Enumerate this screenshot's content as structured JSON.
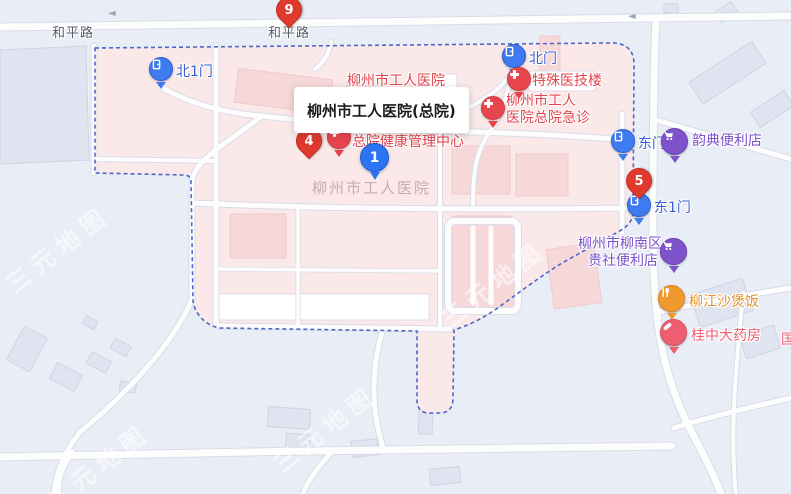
{
  "map": {
    "road_label_left": "和平路",
    "road_label_center": "和平路",
    "road_arrow": "◄",
    "watermark": "三元地图",
    "area_label": "柳州市工人医院",
    "edge_partial_label": "国"
  },
  "popup": {
    "title": "柳州市工人医院(总院)"
  },
  "pins": {
    "pin9": "9",
    "pin4": "4",
    "pin5": "5",
    "pin1": "1"
  },
  "gates": {
    "north1": "北1门",
    "north": "北门",
    "east": "东门",
    "east1": "东1门"
  },
  "pois": {
    "special_building": "特殊医技楼",
    "emergency_line1": "柳州市工人",
    "emergency_line2": "医院总院急诊",
    "hidden_top": "柳州市工人医院",
    "health_line1": "柳州市工人医院",
    "health_line2": "总院健康管理中心",
    "yundian": "韵典便利店",
    "guishe_line1": "柳州市柳南区",
    "guishe_line2": "贵社便利店",
    "liujiang": "柳江沙煲饭",
    "pharmacy": "桂中大药房"
  },
  "colors": {
    "campus_fill": "#fbe9e9",
    "boundary_dash": "#4e68c8",
    "gate_blue": "#3e7af0",
    "poi_red": "#e8444e",
    "pin_red": "#e0392d",
    "marker_blue": "#2d74f3",
    "shop_purple": "#7e52cb",
    "food_orange": "#f0992f",
    "pharmacy_pink": "#ec5e70"
  }
}
